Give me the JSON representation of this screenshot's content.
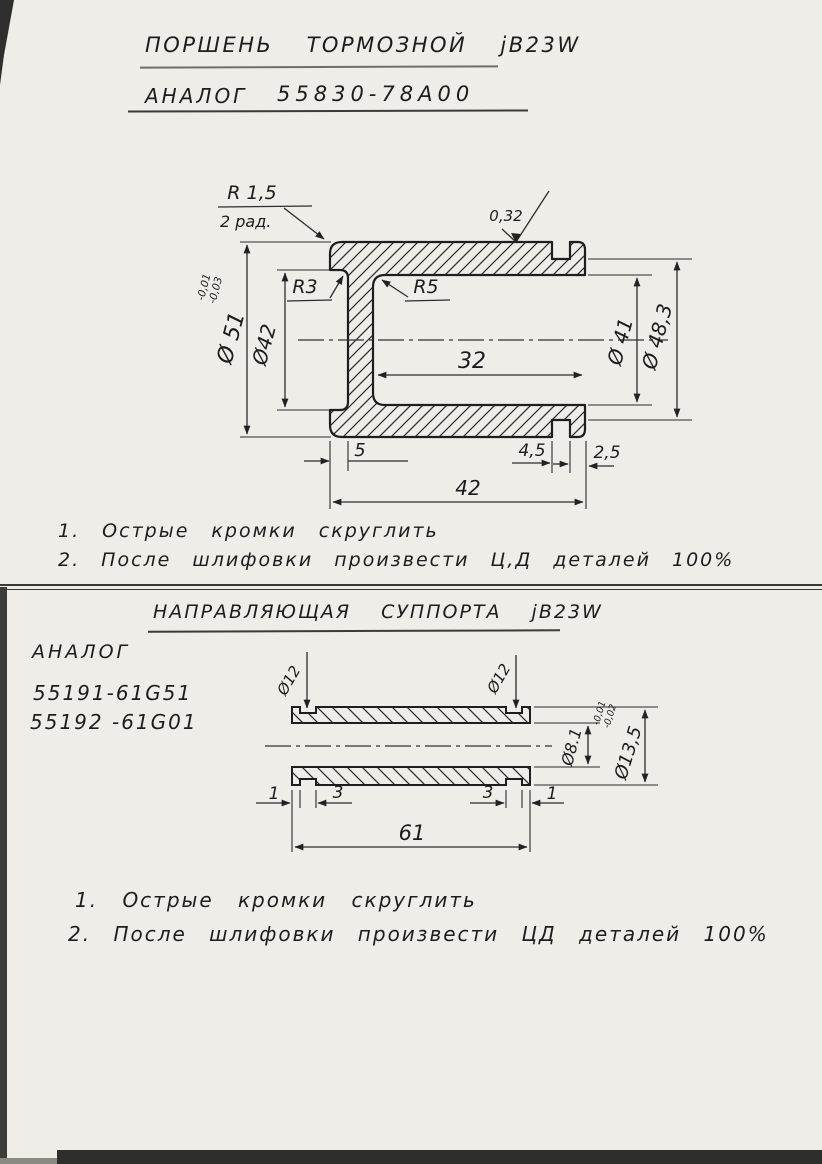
{
  "colors": {
    "paper": "#eeede8",
    "ink": "#1e1e1e"
  },
  "piston": {
    "title": "ПОРШЕНЬ ТОРМОЗНОЙ jB23W",
    "analog_label": "АНАЛОГ",
    "analog_number": "55830-78А00",
    "callout_radius": "R 1,5",
    "callout_radius_sub": "2 рад.",
    "roughness": "0,32",
    "r3": "R3",
    "r5": "R5",
    "dia_51": "Ø 51",
    "dia_51_tol_top": "-0,01",
    "dia_51_tol_bottom": "-0,03",
    "dia_42": "Ø42",
    "dia_41": "Ø 41",
    "dia_48_3": "Ø 48,3",
    "len_32": "32",
    "len_5": "5",
    "len_4_5": "4,5",
    "len_2_5": "2,5",
    "len_42": "42",
    "notes": [
      "1. Острые кромки скруглить",
      "2. После шлифовки произвести Ц,Д деталей 100%"
    ]
  },
  "guide": {
    "title": "НАПРАВЛЯЮЩАЯ СУППОРТА jB23W",
    "analog_label": "АНАЛОГ",
    "analog_numbers": [
      "55191-61G51",
      "55192 -61G01"
    ],
    "dia_12_left": "Ø12",
    "dia_12_right": "Ø12",
    "dia_8_1": "Ø8.1",
    "dia_13_5": "Ø13,5",
    "dia_13_5_tol_top": "-0,01",
    "dia_13_5_tol_bottom": "-0,02",
    "len_1_left": "1",
    "len_3_left": "3",
    "len_3_right": "3",
    "len_1_right": "1",
    "len_61": "61",
    "notes": [
      "1. Острые кромки скруглить",
      "2. После шлифовки произвести ЦД деталей 100%"
    ]
  }
}
